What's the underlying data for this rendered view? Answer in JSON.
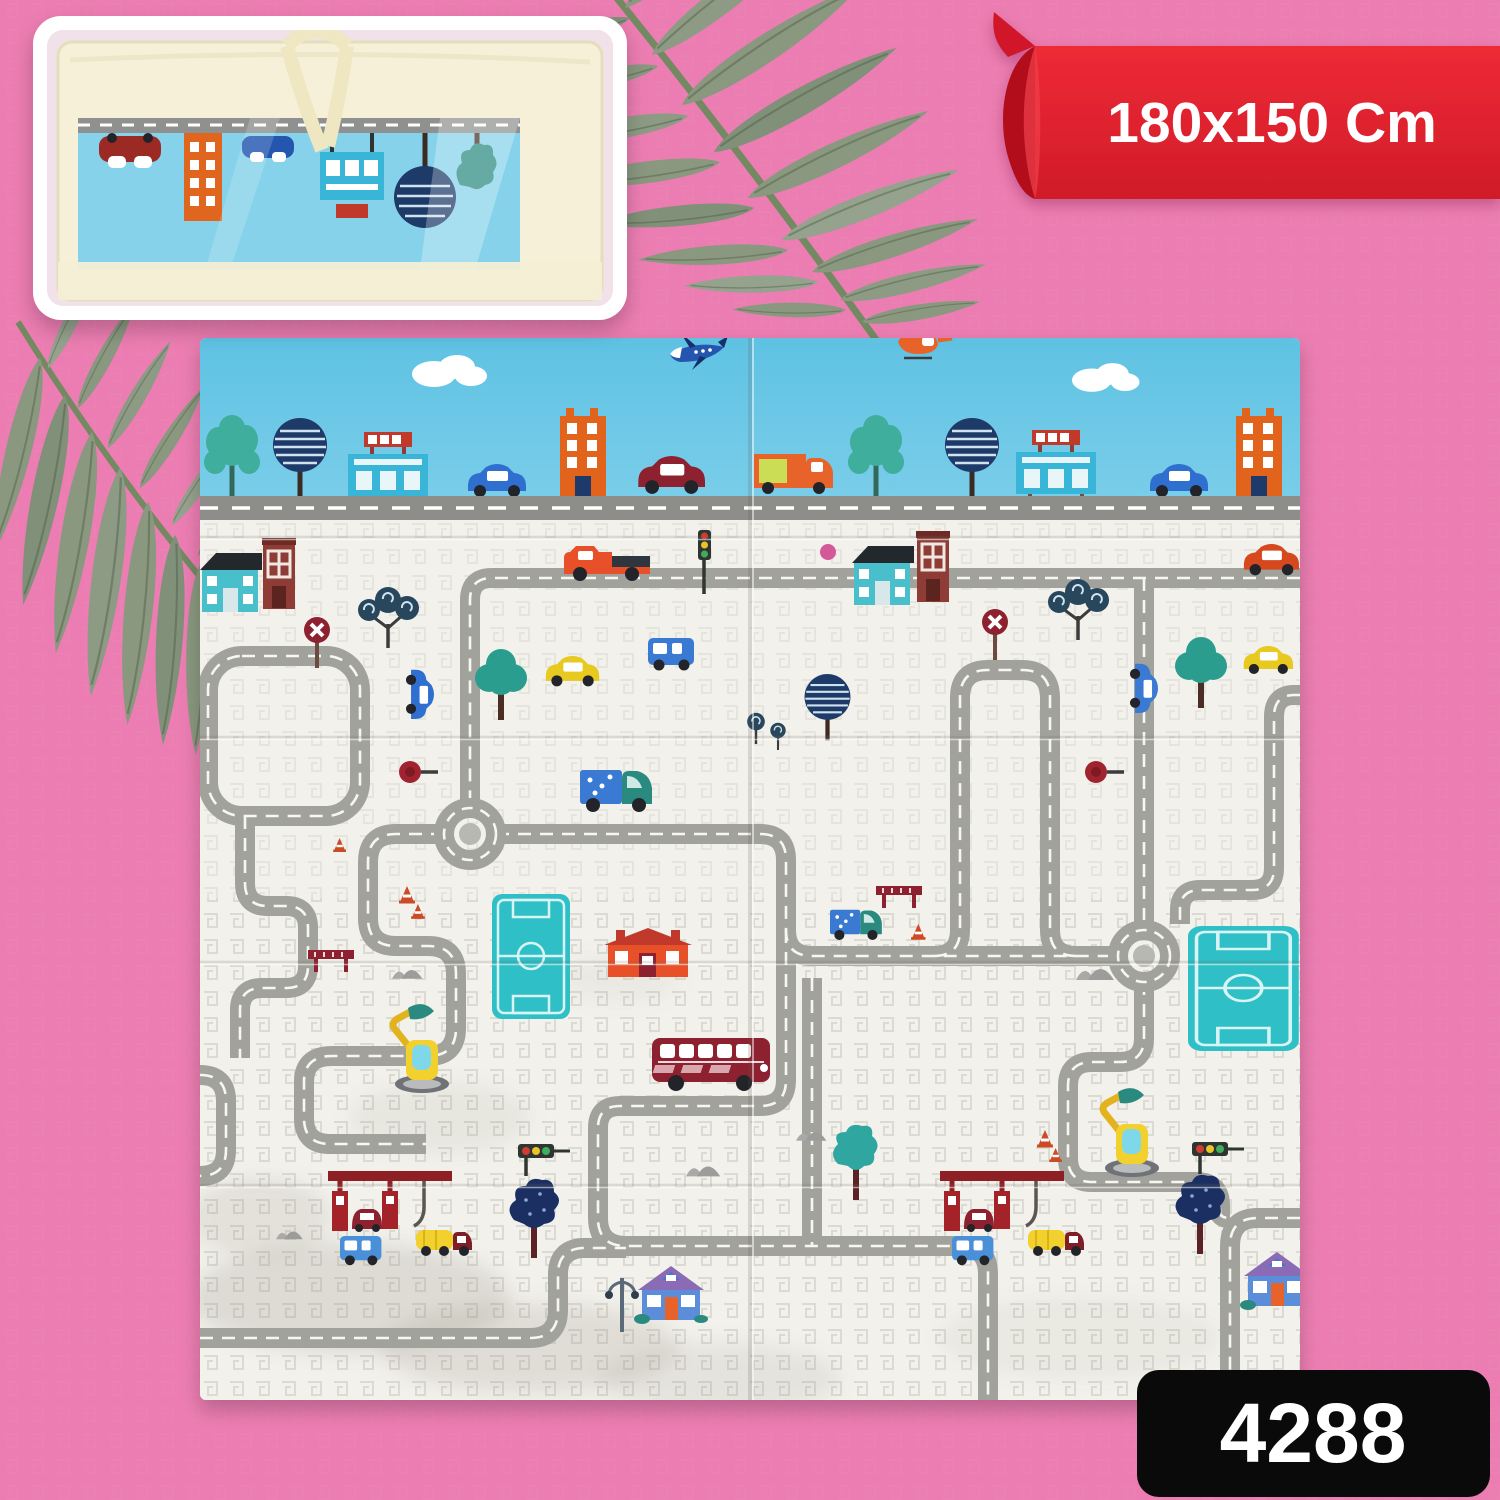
{
  "scene": {
    "background_color": "#ec7db2",
    "description": "e-commerce product photo of a foldable baby play mat with city road print, lying on a pink background decorated with fern palm branches"
  },
  "ribbon": {
    "label": "180x150 Cm",
    "bg_color": "#e32330",
    "curl_color": "#b30f1d",
    "text_color": "#ffffff"
  },
  "badge": {
    "sku": "4288",
    "bg_color": "#0a0a0a",
    "text_color": "#ffffff"
  },
  "inset": {
    "content": "folded-play-mat-packed-in-translucent-carry-bag",
    "bag_color": "#f6f0d9",
    "mat_window_color": "#86d2ea"
  },
  "mat": {
    "theme": "city-roads-play-mat",
    "panels": 2,
    "sky_color": "#69c7e4",
    "ground_color": "#f2f1eb",
    "road_color": "#a2a29c",
    "field_color": "#2fbfc6",
    "elements": [
      "airplane-icon",
      "helicopter-icon",
      "cloud-icon",
      "billboard-icon",
      "orange-building-icon",
      "teal-house-icon",
      "brick-building-icon",
      "red-house-icon",
      "blue-house-icon",
      "car-icon",
      "van-icon",
      "pickup-truck-icon",
      "double-decker-bus-icon",
      "tanker-truck-icon",
      "delivery-truck-icon",
      "excavator-icon",
      "gas-station-icon",
      "roundabout-icon",
      "football-field-icon",
      "tree-icon",
      "lollipop-tree-icon",
      "traffic-light-icon",
      "traffic-cone-icon",
      "no-entry-sign-icon",
      "street-lamp-icon",
      "mountain-icon",
      "barrier-icon"
    ]
  },
  "decor": {
    "leaves": "fern-palm-branches",
    "leaf_color": "#87997f"
  }
}
